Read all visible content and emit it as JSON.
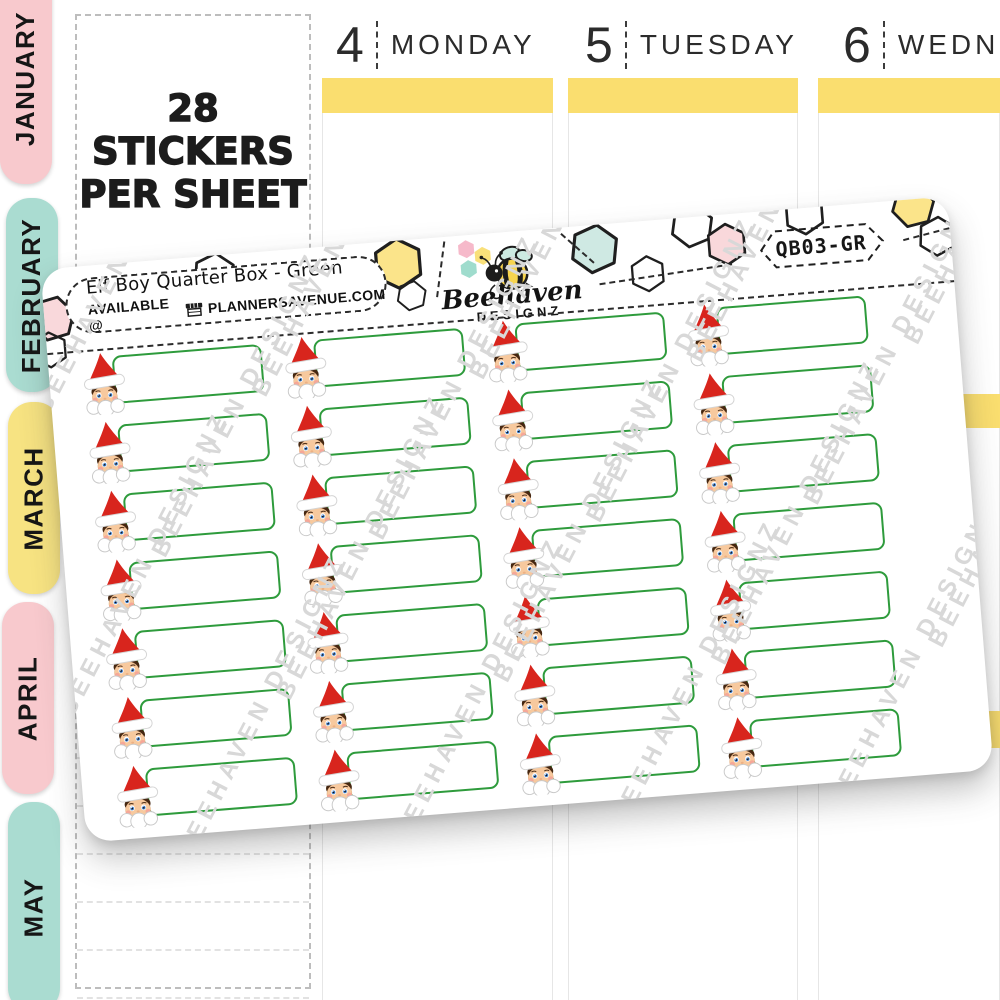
{
  "background": {
    "months": [
      {
        "label": "JANUARY",
        "color": "#f8c9cd"
      },
      {
        "label": "FEBRUARY",
        "color": "#aadcd1"
      },
      {
        "label": "MARCH",
        "color": "#f7e382"
      },
      {
        "label": "APRIL",
        "color": "#f8c9cd"
      },
      {
        "label": "MAY",
        "color": "#aadcd1"
      }
    ],
    "sticker_count_line1": "28 STICKERS",
    "sticker_count_line2": "PER SHEET",
    "days": [
      {
        "number": "4",
        "name": "MONDAY"
      },
      {
        "number": "5",
        "name": "TUESDAY"
      },
      {
        "number": "6",
        "name": "WEDNESDAY"
      }
    ],
    "highlight_color": "#fade6f"
  },
  "sheet": {
    "title": "Elf Boy Quarter Box - Green",
    "availability_prefix": "AVAILABLE @",
    "availability_site": "PLANNERSAVENUE.COM",
    "sku": "QB03-GR",
    "brand_name": "Beehaven",
    "brand_sub": "DESIGNZ",
    "watermark_text": "BEEHAVEN DESIGNZ",
    "grid": {
      "rows": 7,
      "columns": 4,
      "total_stickers": 28
    },
    "colors": {
      "box_green": "#2e9b3c",
      "hat_red": "#d8251d",
      "watermark": "#d8d8d8",
      "hex_pink": "#f9d8db",
      "hex_yellow": "#fbe48a",
      "hex_teal": "#cfe9e3"
    }
  }
}
